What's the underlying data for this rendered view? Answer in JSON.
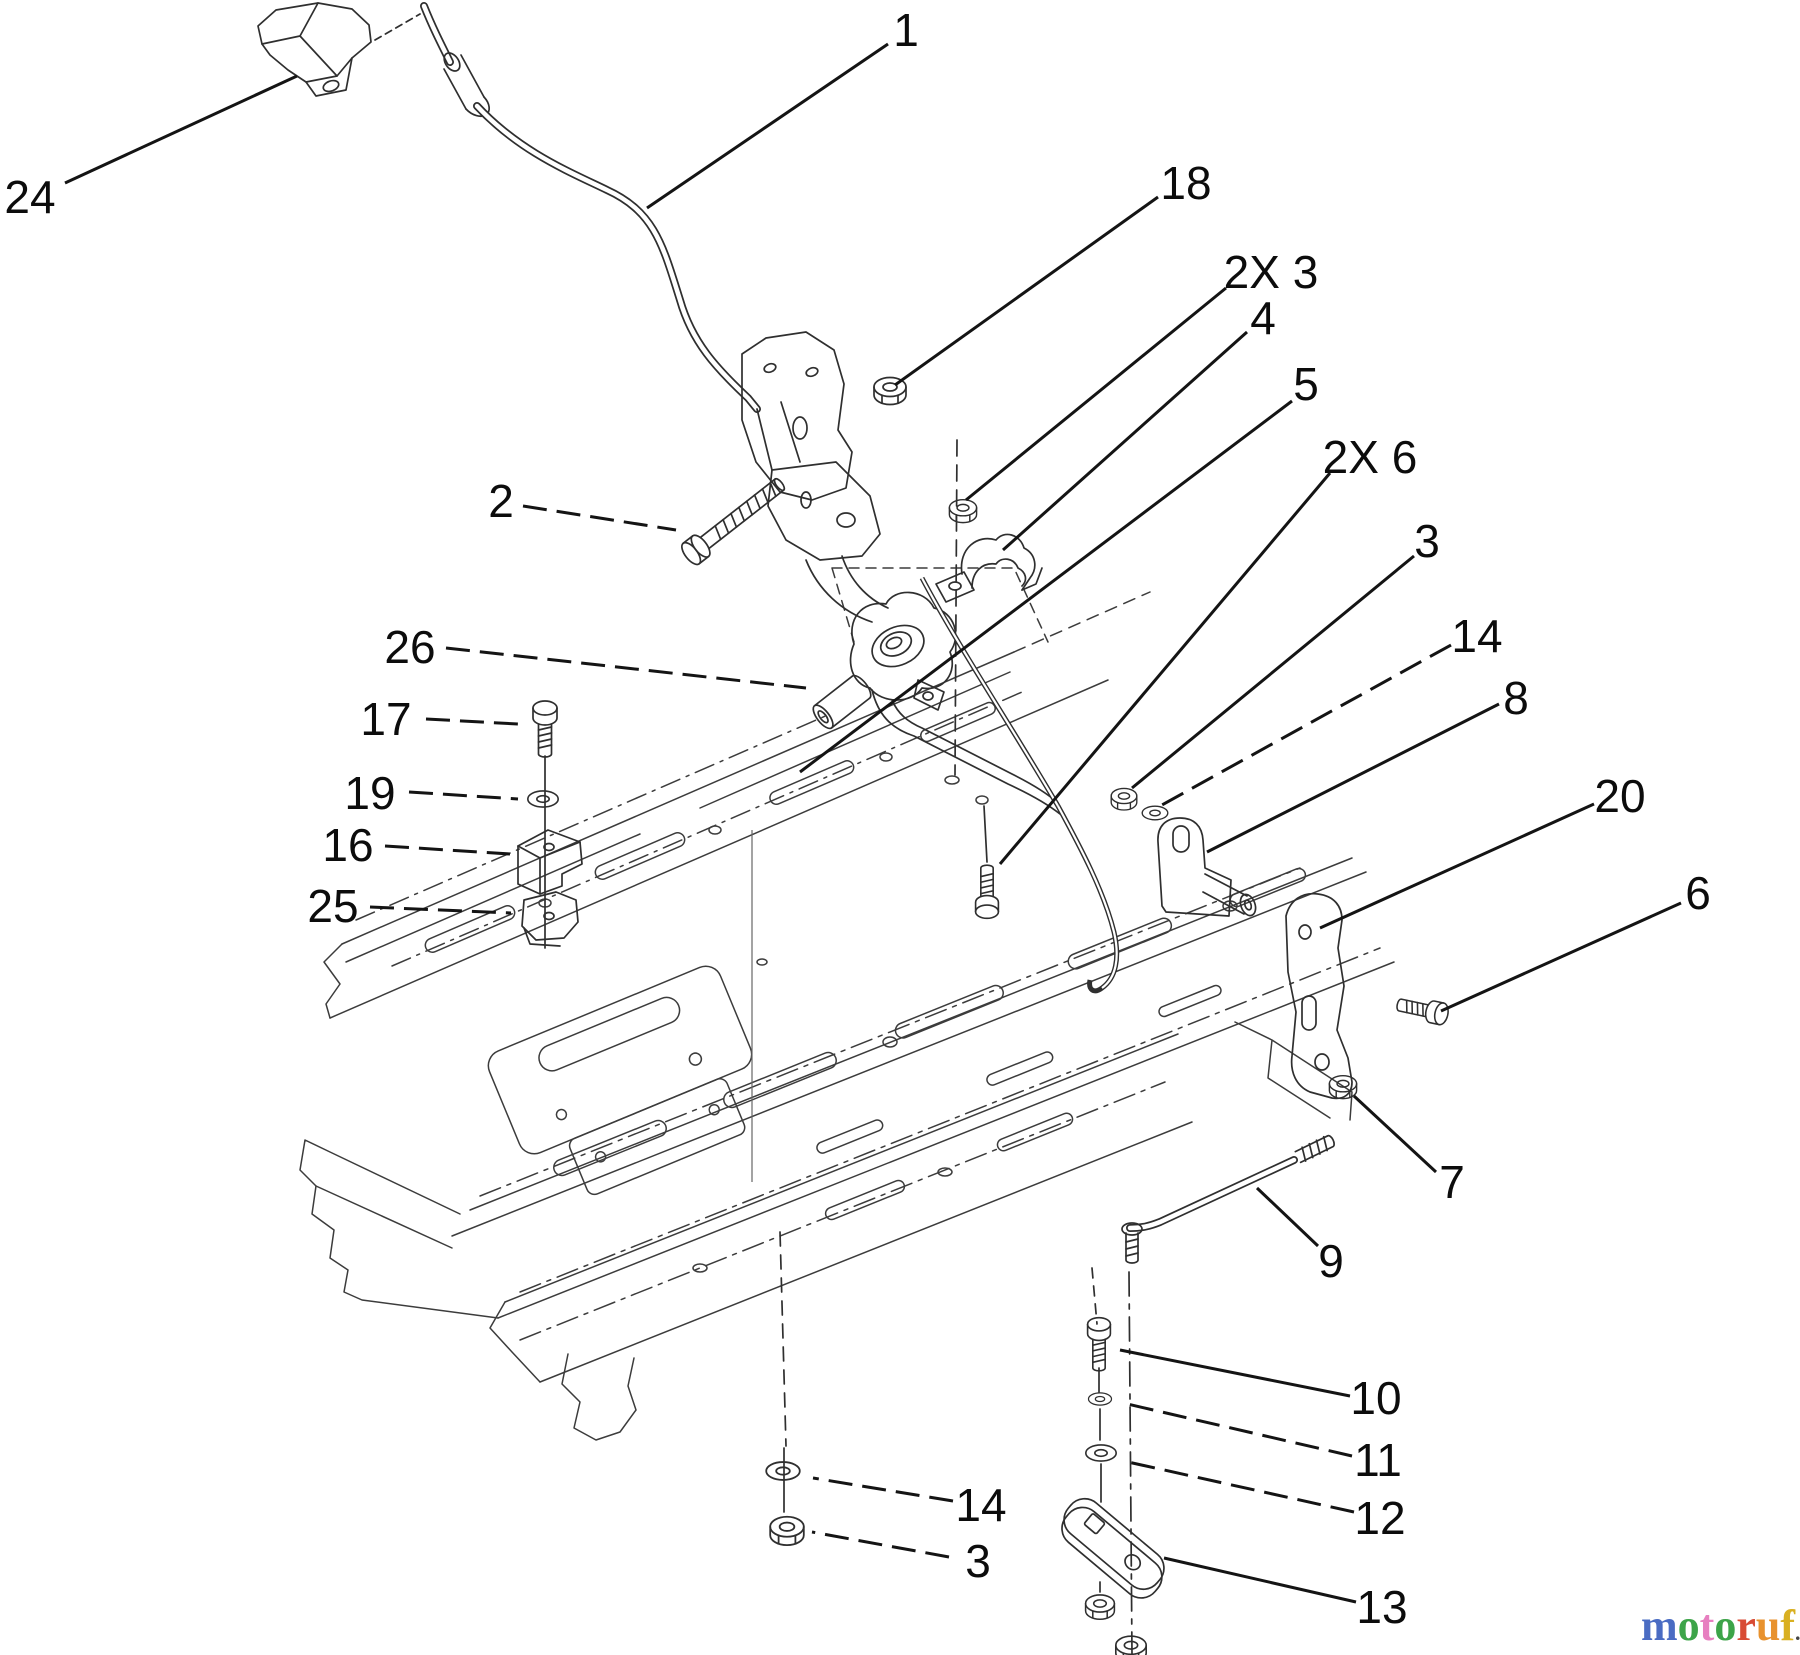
{
  "diagram": {
    "title_visible_text": null,
    "callouts": [
      {
        "id": "24",
        "text": "24",
        "tx": 30,
        "ty": 213,
        "x1": 65,
        "y1": 183,
        "x2": 297,
        "y2": 76,
        "dashed": false
      },
      {
        "id": "1",
        "text": "1",
        "tx": 906,
        "ty": 46,
        "x1": 888,
        "y1": 44,
        "x2": 647,
        "y2": 208,
        "dashed": false
      },
      {
        "id": "18",
        "text": "18",
        "tx": 1186,
        "ty": 199,
        "x1": 1158,
        "y1": 197,
        "x2": 895,
        "y2": 385,
        "dashed": false
      },
      {
        "id": "2x3",
        "text": "2X 3",
        "tx": 1271,
        "ty": 288,
        "x1": 1226,
        "y1": 288,
        "x2": 966,
        "y2": 500,
        "dashed": false
      },
      {
        "id": "4",
        "text": "4",
        "tx": 1263,
        "ty": 334,
        "x1": 1247,
        "y1": 332,
        "x2": 1003,
        "y2": 550,
        "dashed": false
      },
      {
        "id": "5",
        "text": "5",
        "tx": 1306,
        "ty": 400,
        "x1": 1292,
        "y1": 401,
        "x2": 800,
        "y2": 772,
        "dashed": false
      },
      {
        "id": "2x6",
        "text": "2X 6",
        "tx": 1370,
        "ty": 473,
        "x1": 1330,
        "y1": 473,
        "x2": 1000,
        "y2": 864,
        "dashed": false
      },
      {
        "id": "3r",
        "text": "3",
        "tx": 1427,
        "ty": 557,
        "x1": 1414,
        "y1": 556,
        "x2": 1132,
        "y2": 788,
        "dashed": false
      },
      {
        "id": "14r",
        "text": "14",
        "tx": 1477,
        "ty": 652,
        "x1": 1451,
        "y1": 645,
        "x2": 1160,
        "y2": 806,
        "dashed": true
      },
      {
        "id": "8",
        "text": "8",
        "tx": 1516,
        "ty": 714,
        "x1": 1499,
        "y1": 704,
        "x2": 1207,
        "y2": 852,
        "dashed": false
      },
      {
        "id": "20",
        "text": "20",
        "tx": 1620,
        "ty": 812,
        "x1": 1594,
        "y1": 804,
        "x2": 1320,
        "y2": 928,
        "dashed": false
      },
      {
        "id": "6",
        "text": "6",
        "tx": 1698,
        "ty": 909,
        "x1": 1681,
        "y1": 903,
        "x2": 1441,
        "y2": 1011,
        "dashed": false
      },
      {
        "id": "7",
        "text": "7",
        "tx": 1452,
        "ty": 1198,
        "x1": 1436,
        "y1": 1172,
        "x2": 1354,
        "y2": 1096,
        "dashed": false
      },
      {
        "id": "9",
        "text": "9",
        "tx": 1331,
        "ty": 1277,
        "x1": 1318,
        "y1": 1246,
        "x2": 1257,
        "y2": 1188,
        "dashed": false
      },
      {
        "id": "10",
        "text": "10",
        "tx": 1376,
        "ty": 1414,
        "x1": 1350,
        "y1": 1396,
        "x2": 1120,
        "y2": 1350,
        "dashed": false
      },
      {
        "id": "11",
        "text": "11",
        "tx": 1378,
        "ty": 1476,
        "x1": 1352,
        "y1": 1456,
        "x2": 1123,
        "y2": 1403,
        "dashed": true
      },
      {
        "id": "12",
        "text": "12",
        "tx": 1380,
        "ty": 1534,
        "x1": 1354,
        "y1": 1512,
        "x2": 1128,
        "y2": 1462,
        "dashed": true
      },
      {
        "id": "13",
        "text": "13",
        "tx": 1382,
        "ty": 1623,
        "x1": 1356,
        "y1": 1602,
        "x2": 1164,
        "y2": 1558,
        "dashed": false
      },
      {
        "id": "14b",
        "text": "14",
        "tx": 981,
        "ty": 1521,
        "x1": 953,
        "y1": 1501,
        "x2": 813,
        "y2": 1478,
        "dashed": true
      },
      {
        "id": "3b",
        "text": "3",
        "tx": 978,
        "ty": 1577,
        "x1": 949,
        "y1": 1557,
        "x2": 812,
        "y2": 1532,
        "dashed": true
      },
      {
        "id": "2",
        "text": "2",
        "tx": 501,
        "ty": 517,
        "x1": 523,
        "y1": 506,
        "x2": 676,
        "y2": 530,
        "dashed": true
      },
      {
        "id": "26",
        "text": "26",
        "tx": 410,
        "ty": 663,
        "x1": 446,
        "y1": 648,
        "x2": 806,
        "y2": 688,
        "dashed": true
      },
      {
        "id": "17",
        "text": "17",
        "tx": 386,
        "ty": 735,
        "x1": 426,
        "y1": 719,
        "x2": 518,
        "y2": 724,
        "dashed": true
      },
      {
        "id": "19",
        "text": "19",
        "tx": 370,
        "ty": 809,
        "x1": 409,
        "y1": 792,
        "x2": 518,
        "y2": 799,
        "dashed": true
      },
      {
        "id": "16",
        "text": "16",
        "tx": 348,
        "ty": 861,
        "x1": 385,
        "y1": 846,
        "x2": 510,
        "y2": 854,
        "dashed": true
      },
      {
        "id": "25",
        "text": "25",
        "tx": 333,
        "ty": 922,
        "x1": 370,
        "y1": 907,
        "x2": 511,
        "y2": 913,
        "dashed": true
      }
    ],
    "watermark": {
      "letters": [
        {
          "ch": "m",
          "color": "#4a6cc3"
        },
        {
          "ch": "o",
          "color": "#3da449"
        },
        {
          "ch": "t",
          "color": "#e77fc0"
        },
        {
          "ch": "o",
          "color": "#3da449"
        },
        {
          "ch": "r",
          "color": "#d84b35"
        },
        {
          "ch": "u",
          "color": "#e8922e"
        },
        {
          "ch": "f",
          "color": "#d9b021"
        }
      ],
      "suffix": ".de",
      "suffix_color": "#444444",
      "x": 1641,
      "y": 1640
    }
  }
}
